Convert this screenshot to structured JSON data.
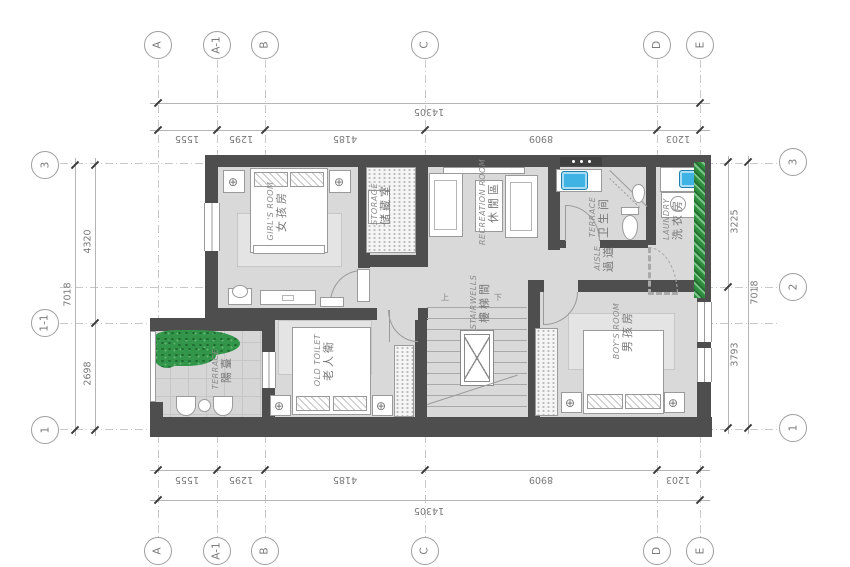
{
  "grid": {
    "top": [
      "A",
      "A-1",
      "B",
      "C",
      "D",
      "E"
    ],
    "bottom": [
      "A",
      "A-1",
      "B",
      "C",
      "D",
      "E"
    ],
    "left": [
      "3",
      "1-1",
      "1"
    ],
    "right": [
      "3",
      "2",
      "1"
    ]
  },
  "dims": {
    "top_total": "14305",
    "top_segs": [
      "1555",
      "1295",
      "4185",
      "8909",
      "1203"
    ],
    "bottom_total": "14305",
    "bottom_segs": [
      "1555",
      "1295",
      "4185",
      "8909",
      "1203"
    ],
    "left_total": "7018",
    "left_segs": [
      "4320",
      "2698"
    ],
    "right_total": "7018",
    "right_segs": [
      "3225",
      "3793"
    ]
  },
  "rooms": {
    "girls": {
      "en": "GIRL'S ROOM",
      "zh": "女孩房"
    },
    "storage": {
      "en": "STORAGE",
      "zh": "储藏室"
    },
    "recreation": {
      "en": "RECREATION ROOM",
      "zh": "休閒區"
    },
    "bathroom": {
      "en": "TERRACE",
      "zh": "卫生间"
    },
    "laundry": {
      "en": "LAUNDRY",
      "zh": "洗衣房"
    },
    "aisle": {
      "en": "AISLE",
      "zh": "過道"
    },
    "stairs": {
      "en": "STAIRWELLS",
      "zh": "樓梯間"
    },
    "old": {
      "en": "OLD TOILET",
      "zh": "老人衛"
    },
    "boys": {
      "en": "BOY'S ROOM",
      "zh": "男孩房"
    },
    "terrace": {
      "en": "TERRACE",
      "zh": "陽臺"
    }
  },
  "stair_marks": {
    "up": "上",
    "down": "下"
  },
  "colors": {
    "wall": "#4e4e4e",
    "floor": "#d9d9d9",
    "plant": "#33954a",
    "sink": "#3fb4e4",
    "line": "#9a9a9a"
  }
}
